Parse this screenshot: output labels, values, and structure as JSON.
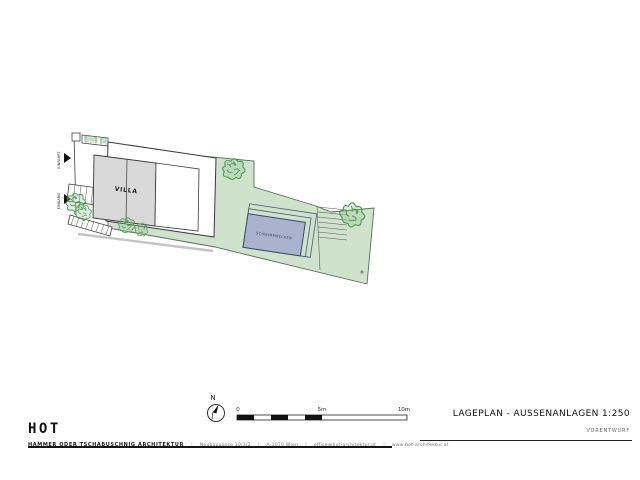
{
  "plan": {
    "villa_label": "VILLA",
    "pool_label": "SCHWIMMBECKEN",
    "driveway_label": "EINFAHRT",
    "entrance_label": "EINGANG"
  },
  "compass": {
    "north": "N"
  },
  "scale_bar": {
    "zero": "0",
    "mid": "5m",
    "end": "10m"
  },
  "title_block": {
    "title": "LAGEPLAN - AUSSENANLAGEN 1:250",
    "phase": "VORENTWURF"
  },
  "firm": {
    "logo": "HOT",
    "name": "HAMMER ODER TSCHABUSCHNIG ARCHITEKTUR",
    "separator": "|",
    "address": "Neubaugasse 10/1/2",
    "city": "A-1070 Wien",
    "email": "office@hot-architektur.at",
    "website": "www.hot-architektur.at"
  },
  "colors": {
    "lawn": "#cfe3cc",
    "pool": "#a9b3ce",
    "building": "#d9d9d9",
    "foliage": "#4a9750",
    "ink": "#1d1d1d"
  }
}
